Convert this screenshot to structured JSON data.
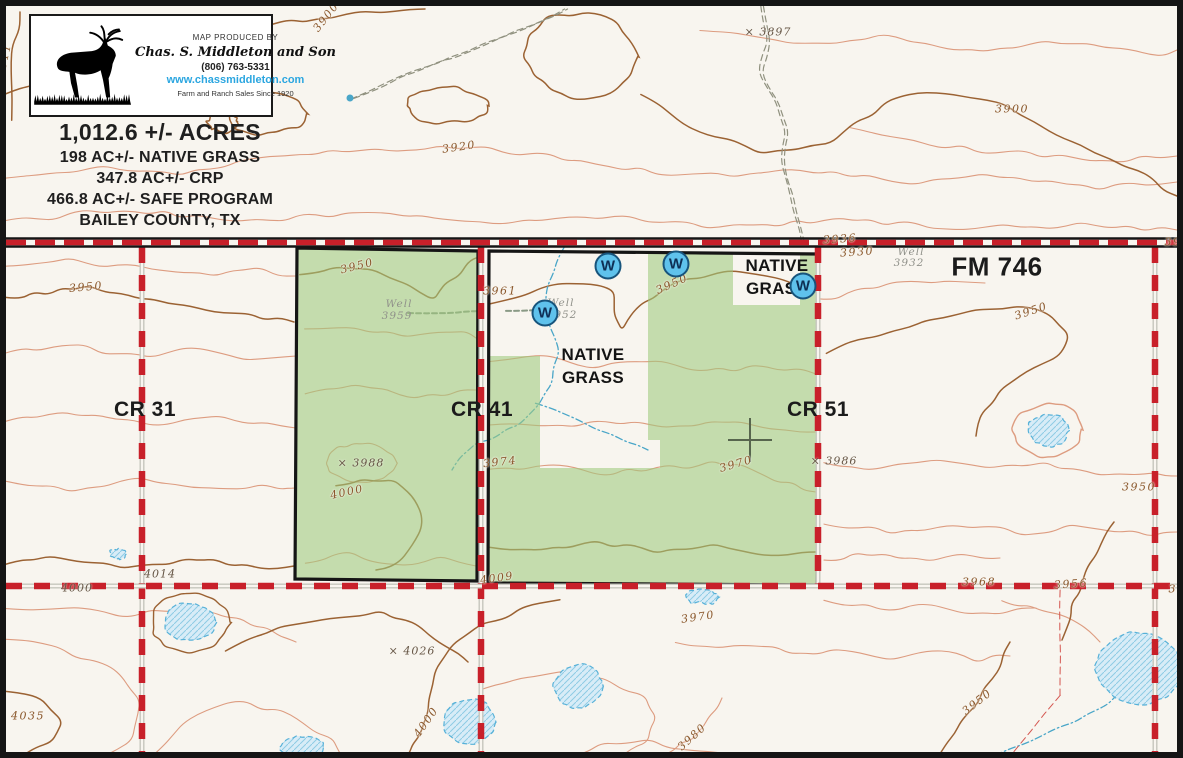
{
  "map": {
    "producer_box": {
      "produced_by": "MAP PRODUCED BY",
      "company": "Chas. S. Middleton and Son",
      "phone": "(806) 763-5331",
      "website": "www.chassmiddleton.com",
      "tagline": "Farm and Ranch Sales Since 1920",
      "website_color": "#2ba6e0"
    },
    "title_block": {
      "acres": "1,012.6 +/- ACRES",
      "native_grass": "198 AC+/- NATIVE GRASS",
      "crp": "347.8 AC+/- CRP",
      "safe_program": "466.8 AC+/- SAFE PROGRAM",
      "county": "BAILEY COUNTY, TX"
    },
    "roads": [
      {
        "label": "CR 31",
        "x": 145,
        "y": 410,
        "kind": "cr"
      },
      {
        "label": "CR 41",
        "x": 482,
        "y": 410,
        "kind": "cr"
      },
      {
        "label": "CR 51",
        "x": 818,
        "y": 410,
        "kind": "cr"
      },
      {
        "label": "FM 746",
        "x": 997,
        "y": 267,
        "kind": "fm"
      }
    ],
    "area_labels": [
      {
        "lines": [
          "NATIVE",
          "GRASS"
        ],
        "x": 593,
        "y": 367
      },
      {
        "lines": [
          "NATIVE",
          "GRASS"
        ],
        "x": 777,
        "y": 278
      }
    ],
    "wells": {
      "symbol": "W",
      "points": [
        {
          "x": 608,
          "y": 266
        },
        {
          "x": 676,
          "y": 264
        },
        {
          "x": 545,
          "y": 313
        },
        {
          "x": 803,
          "y": 286
        }
      ]
    },
    "spot_labels": [
      {
        "t": "3911",
        "x": 4,
        "y": 60,
        "r": -78,
        "c": "idx"
      },
      {
        "t": "3900",
        "x": 326,
        "y": 17,
        "r": -52,
        "c": "idx"
      },
      {
        "t": "× 3897",
        "x": 768,
        "y": 32,
        "r": 0,
        "c": "spot"
      },
      {
        "t": "3900",
        "x": 1012,
        "y": 109,
        "r": 0,
        "c": "idx"
      },
      {
        "t": "3920",
        "x": 459,
        "y": 147,
        "r": -8,
        "c": "idx"
      },
      {
        "t": "3936",
        "x": 840,
        "y": 239,
        "r": -4,
        "c": "idx"
      },
      {
        "t": "3930",
        "x": 857,
        "y": 252,
        "r": -4,
        "c": "idx"
      },
      {
        "t": "Well",
        "x": 911,
        "y": 252,
        "r": 0,
        "c": "muted"
      },
      {
        "t": "3932",
        "x": 909,
        "y": 263,
        "r": 0,
        "c": "muted"
      },
      {
        "t": "39",
        "x": 1173,
        "y": 242,
        "r": 0,
        "c": "idx"
      },
      {
        "t": "3950",
        "x": 86,
        "y": 287,
        "r": -5,
        "c": "idx"
      },
      {
        "t": "3950",
        "x": 357,
        "y": 266,
        "r": -14,
        "c": "idx"
      },
      {
        "t": "3961",
        "x": 500,
        "y": 291,
        "r": 0,
        "c": "idx"
      },
      {
        "t": "Well",
        "x": 399,
        "y": 304,
        "r": 0,
        "c": "muted"
      },
      {
        "t": "3959",
        "x": 397,
        "y": 316,
        "r": 0,
        "c": "muted"
      },
      {
        "t": "Well",
        "x": 561,
        "y": 303,
        "r": 0,
        "c": "muted"
      },
      {
        "t": "3952",
        "x": 562,
        "y": 315,
        "r": 0,
        "c": "muted"
      },
      {
        "t": "3950",
        "x": 672,
        "y": 284,
        "r": -24,
        "c": "idx"
      },
      {
        "t": "3950",
        "x": 1031,
        "y": 311,
        "r": -18,
        "c": "idx"
      },
      {
        "t": "× 3988",
        "x": 361,
        "y": 463,
        "r": 0,
        "c": "spot"
      },
      {
        "t": "4000",
        "x": 347,
        "y": 492,
        "r": -12,
        "c": "idx"
      },
      {
        "t": "3974",
        "x": 500,
        "y": 462,
        "r": -6,
        "c": "idx"
      },
      {
        "t": "3970",
        "x": 736,
        "y": 464,
        "r": -16,
        "c": "idx"
      },
      {
        "t": "× 3986",
        "x": 834,
        "y": 461,
        "r": 0,
        "c": "spot"
      },
      {
        "t": "3950",
        "x": 1139,
        "y": 487,
        "r": 0,
        "c": "idx"
      },
      {
        "t": "4009",
        "x": 497,
        "y": 578,
        "r": -8,
        "c": "idx"
      },
      {
        "t": "4014",
        "x": 160,
        "y": 574,
        "r": 0,
        "c": "spot"
      },
      {
        "t": "4000",
        "x": 77,
        "y": 588,
        "r": 0,
        "c": "spot"
      },
      {
        "t": "3968",
        "x": 979,
        "y": 582,
        "r": 0,
        "c": "idx"
      },
      {
        "t": "3956",
        "x": 1071,
        "y": 584,
        "r": -4,
        "c": "idx"
      },
      {
        "t": "39",
        "x": 1177,
        "y": 589,
        "r": 0,
        "c": "idx"
      },
      {
        "t": "3970",
        "x": 698,
        "y": 617,
        "r": -8,
        "c": "idx"
      },
      {
        "t": "× 4026",
        "x": 412,
        "y": 651,
        "r": 0,
        "c": "spot"
      },
      {
        "t": "4035",
        "x": 28,
        "y": 716,
        "r": 0,
        "c": "idx"
      },
      {
        "t": "4000",
        "x": 426,
        "y": 722,
        "r": -55,
        "c": "idx"
      },
      {
        "t": "3980",
        "x": 692,
        "y": 737,
        "r": -42,
        "c": "idx"
      },
      {
        "t": "3950",
        "x": 977,
        "y": 702,
        "r": -38,
        "c": "idx"
      }
    ],
    "water": [
      {
        "x": 190,
        "y": 622,
        "rx": 26,
        "ry": 19,
        "ring": "d"
      },
      {
        "x": 1048,
        "y": 430,
        "rx": 21,
        "ry": 16,
        "ring": "l"
      },
      {
        "x": 578,
        "y": 686,
        "rx": 25,
        "ry": 22,
        "ring": ""
      },
      {
        "x": 470,
        "y": 722,
        "rx": 26,
        "ry": 23,
        "ring": ""
      },
      {
        "x": 1140,
        "y": 668,
        "rx": 44,
        "ry": 37,
        "ring": ""
      },
      {
        "x": 702,
        "y": 597,
        "rx": 16,
        "ry": 7,
        "ring": ""
      },
      {
        "x": 118,
        "y": 554,
        "rx": 8,
        "ry": 6,
        "ring": ""
      },
      {
        "x": 302,
        "y": 748,
        "rx": 22,
        "ry": 11,
        "ring": ""
      }
    ],
    "colors": {
      "paper": "#f8f5ef",
      "parcel_green": "#9fc97e",
      "contour_light": "#dd9c80",
      "contour_dark": "#9b6233",
      "road_red": "#c8202a",
      "water_fill": "#d8ecf7",
      "water_line": "#57b1d8",
      "boundary_black": "#151515"
    }
  }
}
